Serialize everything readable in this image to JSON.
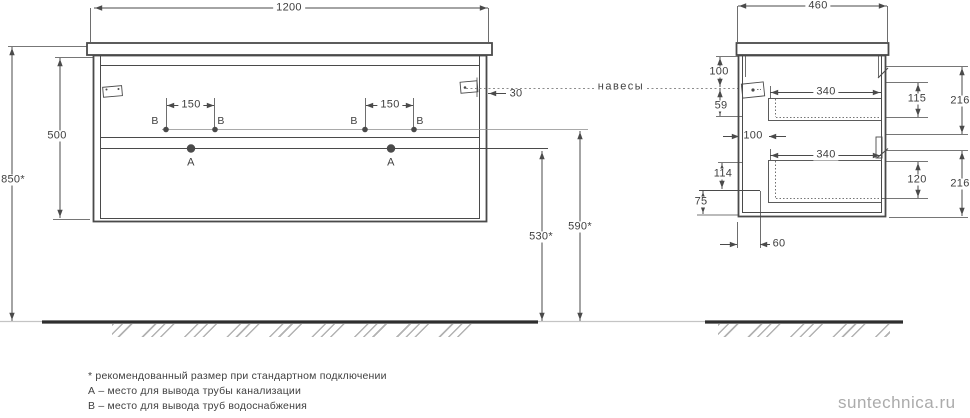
{
  "front_view": {
    "width_mm": "1200",
    "total_height_mm": "850*",
    "cabinet_height_mm": "500",
    "outlet_pair_spacing_mm": "150",
    "hanger_edge_offset_mm": "30",
    "drain_outlet_height_mm": "530*",
    "water_outlet_height_mm": "590*"
  },
  "side_view": {
    "depth_mm": "460",
    "hanger_from_top_mm": "100",
    "hanger_drop_mm": "59",
    "drawer_back_clearance_mm": "100",
    "drawer_inner_depth_mm": "340",
    "drawer1_front_mm": "115",
    "drawer2_front_mm": "120",
    "front_panel_mm": "216",
    "bottom_section_mm": "114",
    "plinth_height_mm": "75",
    "plinth_offset_mm": "60"
  },
  "annotations": {
    "hangers_label": "навесы",
    "point_a": "А",
    "point_b": "В"
  },
  "footnotes": {
    "recommended": "* рекомендованный размер при стандартном подключении",
    "point_a": "А – место для вывода трубы канализации",
    "point_b": "В – место для вывода труб водоснабжения"
  },
  "watermark": "suntechnica.ru",
  "colors": {
    "line": "#4a4a4a",
    "ground": "#2e2e2e",
    "muted": "#9a9a9a",
    "watermark": "#ababab"
  }
}
